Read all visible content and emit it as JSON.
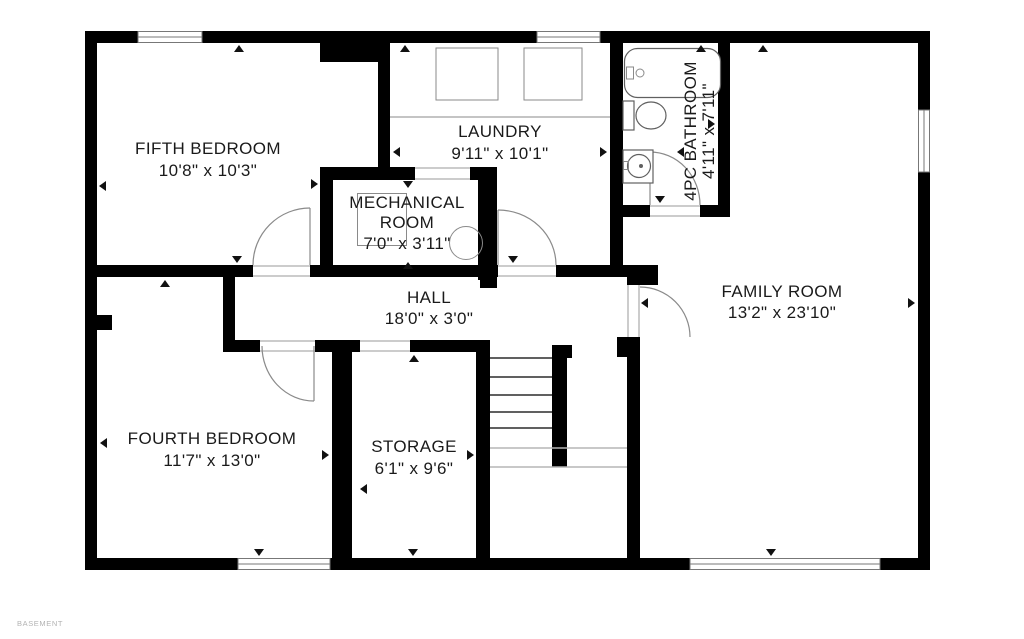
{
  "floor_plan": {
    "watermark": "BASEMENT",
    "rooms": {
      "fifth_bedroom": {
        "name": "FIFTH BEDROOM",
        "dims": "10'8\" x 10'3\""
      },
      "laundry": {
        "name": "LAUNDRY",
        "dims": "9'11\" x 10'1\""
      },
      "mechanical": {
        "name_line1": "MECHANICAL",
        "name_line2": "ROOM",
        "dims": "7'0\" x 3'11\""
      },
      "bathroom": {
        "name": "4PC BATHROOM",
        "dims": "4'11\" x 7'11\""
      },
      "family_room": {
        "name": "FAMILY ROOM",
        "dims": "13'2\" x 23'10\""
      },
      "hall": {
        "name": "HALL",
        "dims": "18'0\" x 3'0\""
      },
      "fourth_bedroom": {
        "name": "FOURTH BEDROOM",
        "dims": "11'7\" x 13'0\""
      },
      "storage": {
        "name": "STORAGE",
        "dims": "6'1\" x 9'6\""
      }
    },
    "colors": {
      "wall": "#000000",
      "background": "#ffffff",
      "label_text": "#1a1a1a",
      "watermark_text": "#b3b3b3"
    }
  }
}
